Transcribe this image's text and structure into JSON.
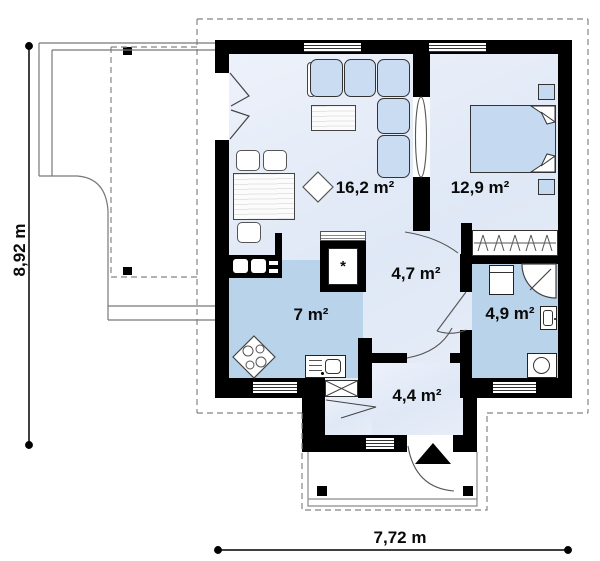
{
  "plan": {
    "title": "house-floor-plan",
    "rooms": [
      {
        "id": "living-room",
        "area": "16,2 m²"
      },
      {
        "id": "bedroom",
        "area": "12,9 m²"
      },
      {
        "id": "hallway",
        "area": "4,7 m²"
      },
      {
        "id": "kitchen",
        "area": "7 m²"
      },
      {
        "id": "bathroom",
        "area": "4,9 m²"
      },
      {
        "id": "entrance-hall",
        "area": "4,4 m²"
      }
    ],
    "dimensions": {
      "overall_depth": "8,92 m",
      "overall_width": "7,72 m"
    },
    "symbols": {
      "fridge_star": "*"
    },
    "colors": {
      "wall": "#000000",
      "floor_light": "#e3eaf7",
      "floor_blue": "#b9d3ea",
      "furniture_blue": "#c9dcf2",
      "outline_gray": "#858585"
    }
  }
}
